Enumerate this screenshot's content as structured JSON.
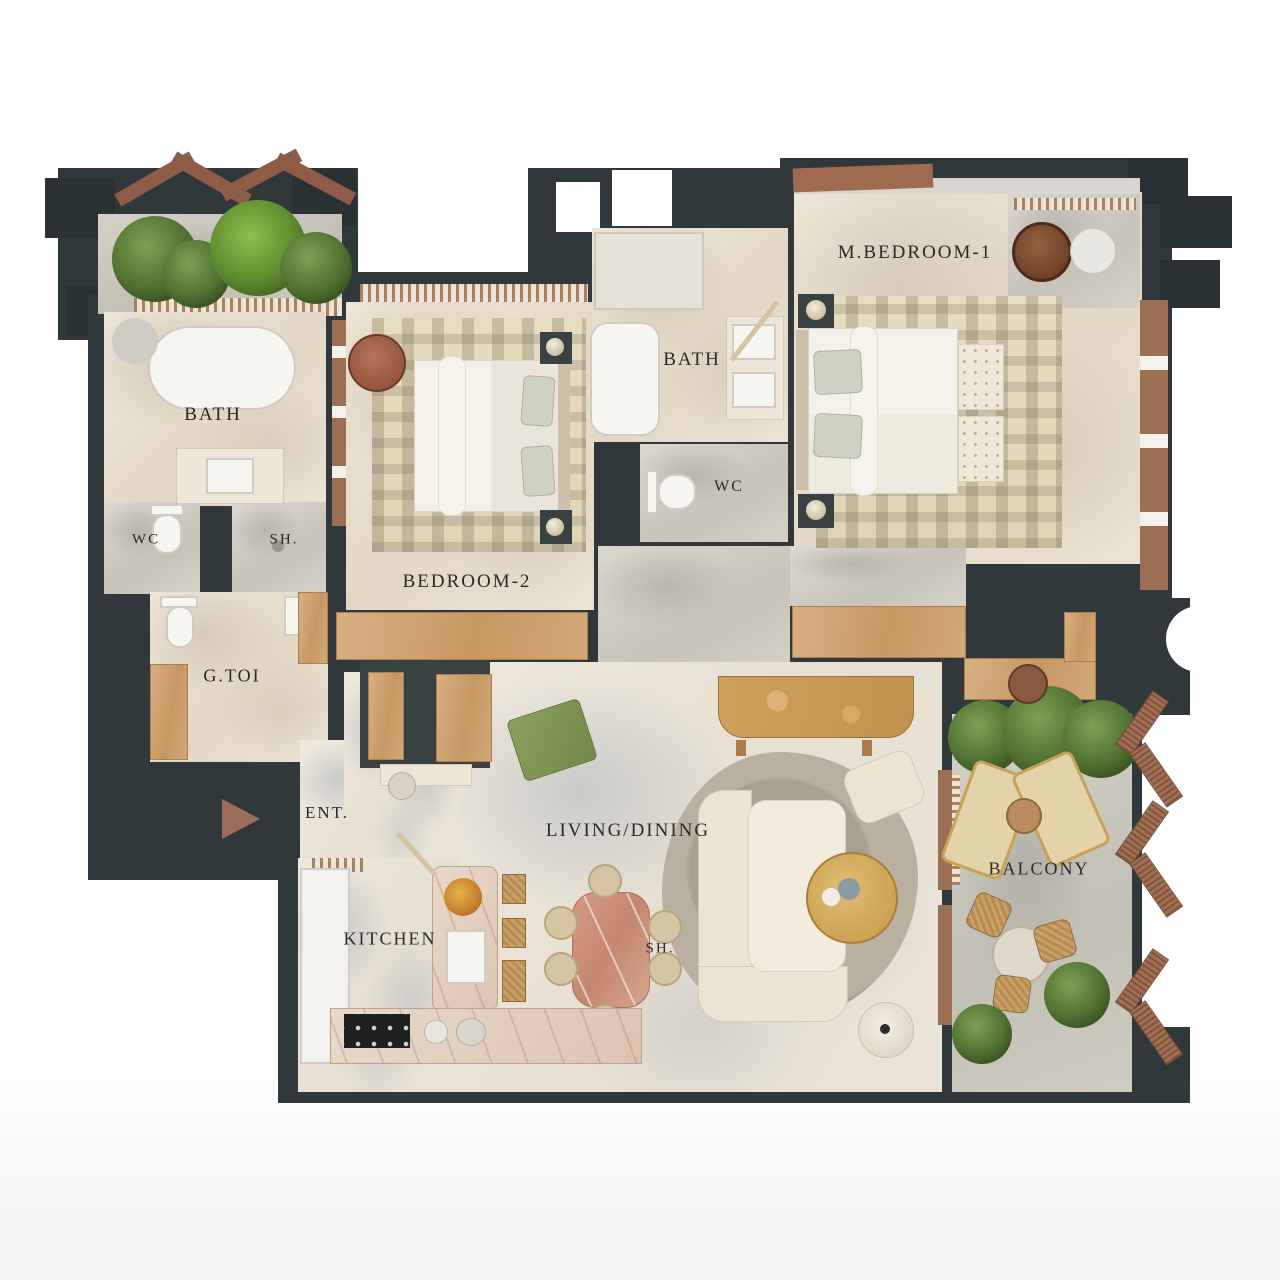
{
  "plan": {
    "type": "apartment-floor-plan",
    "colors": {
      "wall": "#31383b",
      "wood": "#c9a06f",
      "terracotta": "#9c6c58",
      "plant_green": "#55713c",
      "marble_floor": "#ece3d4",
      "pink_marble_table": "#cf9582"
    },
    "rooms": {
      "m_bedroom_1": "M.BEDROOM-1",
      "bath_master": "BATH",
      "wc_master": "WC",
      "bath_left": "BATH",
      "wc_left": "WC",
      "sh_left": "SH.",
      "g_toi": "G.TOI",
      "ent": "ENT.",
      "bedroom_2": "BEDROOM-2",
      "living_dining": "LIVING/DINING",
      "kitchen": "KITCHEN",
      "sh_dining": "SH.",
      "balcony": "BALCONY"
    }
  }
}
